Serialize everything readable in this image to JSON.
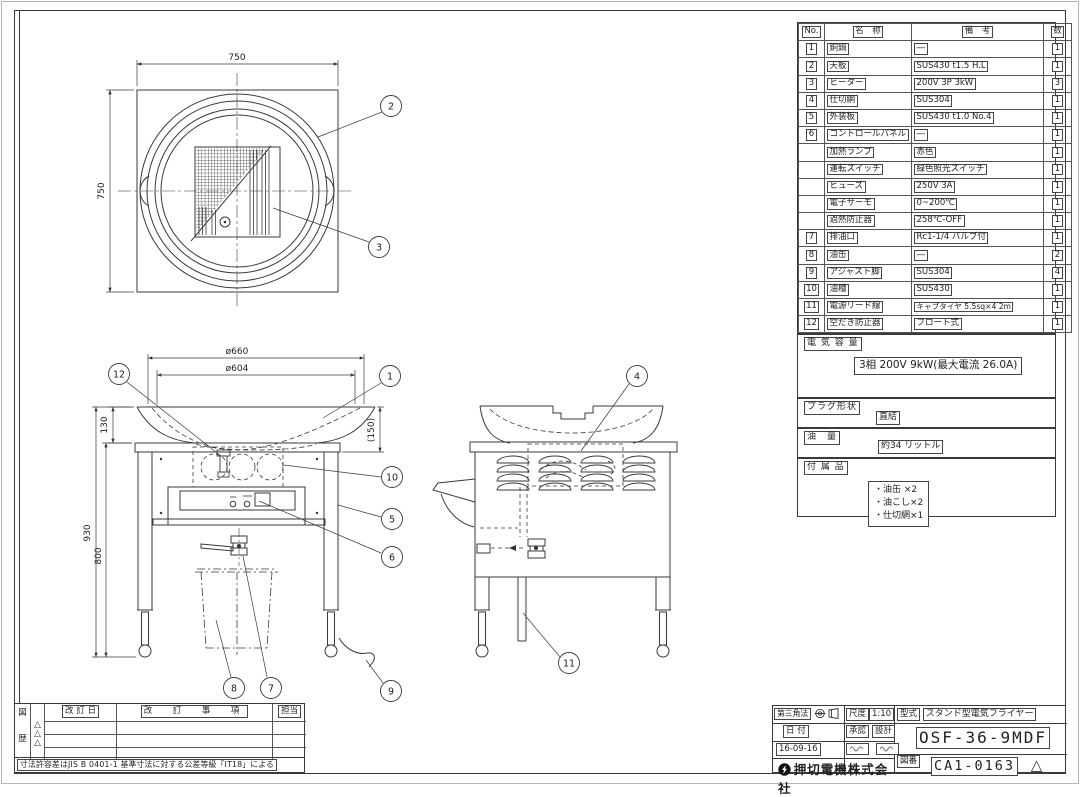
{
  "sheet": {
    "tolerance_note": "寸法許容差はJIS B 0401-1 基準寸法に対する公差等級「IT18」による"
  },
  "parts_table": {
    "headers": {
      "no": "No.",
      "name": "名　称",
      "remark": "備　考",
      "qty": "数"
    },
    "rows": [
      {
        "no": "1",
        "name": "銅鍋",
        "remark": "―",
        "qty": "1"
      },
      {
        "no": "2",
        "name": "天板",
        "remark": "SUS430 t1.5 H.L",
        "qty": "1"
      },
      {
        "no": "3",
        "name": "ヒーター",
        "remark": "200V 3P 3kW",
        "qty": "3"
      },
      {
        "no": "4",
        "name": "仕切網",
        "remark": "SUS304",
        "qty": "1"
      },
      {
        "no": "5",
        "name": "外装板",
        "remark": "SUS430 t1.0 No.4",
        "qty": "1"
      },
      {
        "no": "6",
        "name": "コントロールパネル",
        "remark": "―",
        "qty": "1"
      },
      {
        "no": "",
        "name": "加熱ランプ",
        "remark": "赤色",
        "qty": "1"
      },
      {
        "no": "",
        "name": "運転スイッチ",
        "remark": "緑色照光スイッチ",
        "qty": "1"
      },
      {
        "no": "",
        "name": "ヒューズ",
        "remark": "250V 3A",
        "qty": "1"
      },
      {
        "no": "",
        "name": "電子サーモ",
        "remark": "0~200℃",
        "qty": "1"
      },
      {
        "no": "",
        "name": "過熱防止器",
        "remark": "258℃-OFF",
        "qty": "1"
      },
      {
        "no": "7",
        "name": "排油口",
        "remark": "Rc1-1/4 バルブ付",
        "qty": "1"
      },
      {
        "no": "8",
        "name": "油缶",
        "remark": "―",
        "qty": "2"
      },
      {
        "no": "9",
        "name": "アジャスト脚",
        "remark": "SUS304",
        "qty": "4"
      },
      {
        "no": "10",
        "name": "油槽",
        "remark": "SUS430",
        "qty": "1"
      },
      {
        "no": "11",
        "name": "電源リード線",
        "remark": "キャブタイヤ 5.5sq×4 2m",
        "qty": "1"
      },
      {
        "no": "12",
        "name": "空だき防止器",
        "remark": "フロート式",
        "qty": "1"
      }
    ]
  },
  "specs": {
    "electric_label": "電 気 容 量",
    "electric_value": "3相 200V 9kW(最大電流 26.0A)",
    "plug_label": "プラグ形状",
    "plug_value": "直結",
    "oil_label": "油　量",
    "oil_value": "約34 リットル",
    "accessories_label": "付 属 品",
    "accessories": {
      "a0": "・油缶 ×2",
      "a1": "・油こし×2",
      "a2": "・仕切網×1"
    }
  },
  "revision_table": {
    "side_label_top": "図",
    "side_label_bottom": "歴",
    "mark": "△",
    "headers": {
      "date": "改 訂 日",
      "item": "改　訂　事　項",
      "charge": "担当"
    }
  },
  "title_block": {
    "projection_label": "第三角法",
    "scale_label": "尺度",
    "scale_value": "1:10",
    "type_label": "型式",
    "type_value": "スタンド型電気フライヤー",
    "date_label": "日 付",
    "date_value": "16-09-16",
    "approve_label": "承認",
    "design_label": "設計",
    "model": "OSF-36-9MDF",
    "company": "押切電機株式会社",
    "dwg_label": "図番",
    "dwg_no": "CA1-0163",
    "revision_mark": "△"
  },
  "drawing": {
    "top_view": {
      "dim_width": "750",
      "dim_height": "750",
      "balloons": {
        "b2": "2",
        "b3": "3"
      }
    },
    "front_view": {
      "dims": {
        "d660": "ø660",
        "d604": "ø604",
        "d130": "130",
        "d150": "(150)",
        "d930": "930",
        "d800": "800"
      },
      "balloons": {
        "b12": "12",
        "b1": "1",
        "b10": "10",
        "b5": "5",
        "b6": "6",
        "b7": "7",
        "b8": "8",
        "b9": "9"
      }
    },
    "side_view": {
      "balloons": {
        "b4": "4",
        "b11": "11"
      }
    }
  }
}
